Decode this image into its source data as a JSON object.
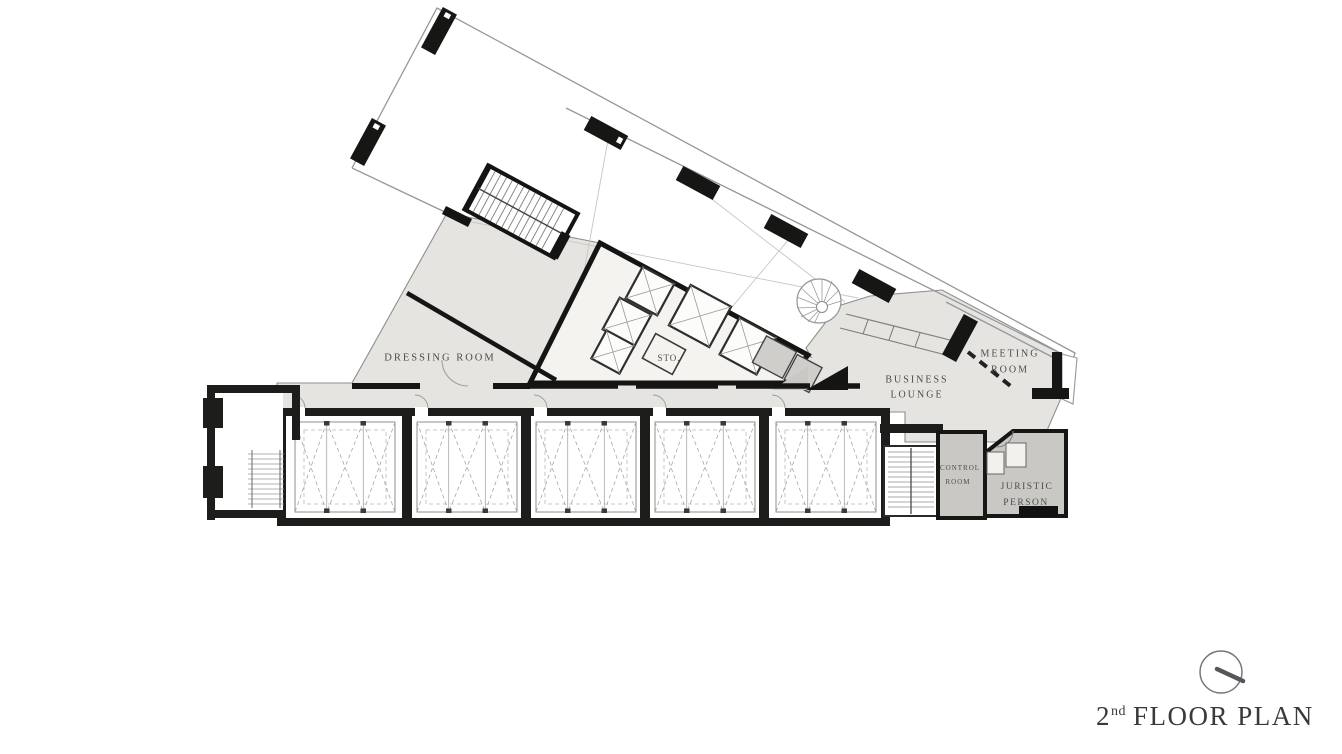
{
  "title": {
    "number": "2",
    "ordinal": "nd",
    "text": "FLOOR PLAN"
  },
  "room_labels": {
    "dressing_room": "DRESSING ROOM",
    "storage": "STO.",
    "business_lounge_line1": "BUSINESS",
    "business_lounge_line2": "LOUNGE",
    "meeting_room_line1": "MEETING",
    "meeting_room_line2": "ROOM",
    "control_room_line1": "CONTROL",
    "control_room_line2": "ROOM",
    "juristic_person_line1": "JURISTIC",
    "juristic_person_line2": "PERSON"
  },
  "icons": {
    "north_indicator": "north-indicator"
  },
  "colors": {
    "wall": "#1d1d1b",
    "area_light": "#e5e4e0",
    "area_dark": "#c9c8c4",
    "thin_line": "#98989a",
    "text": "#4c4c4a"
  }
}
